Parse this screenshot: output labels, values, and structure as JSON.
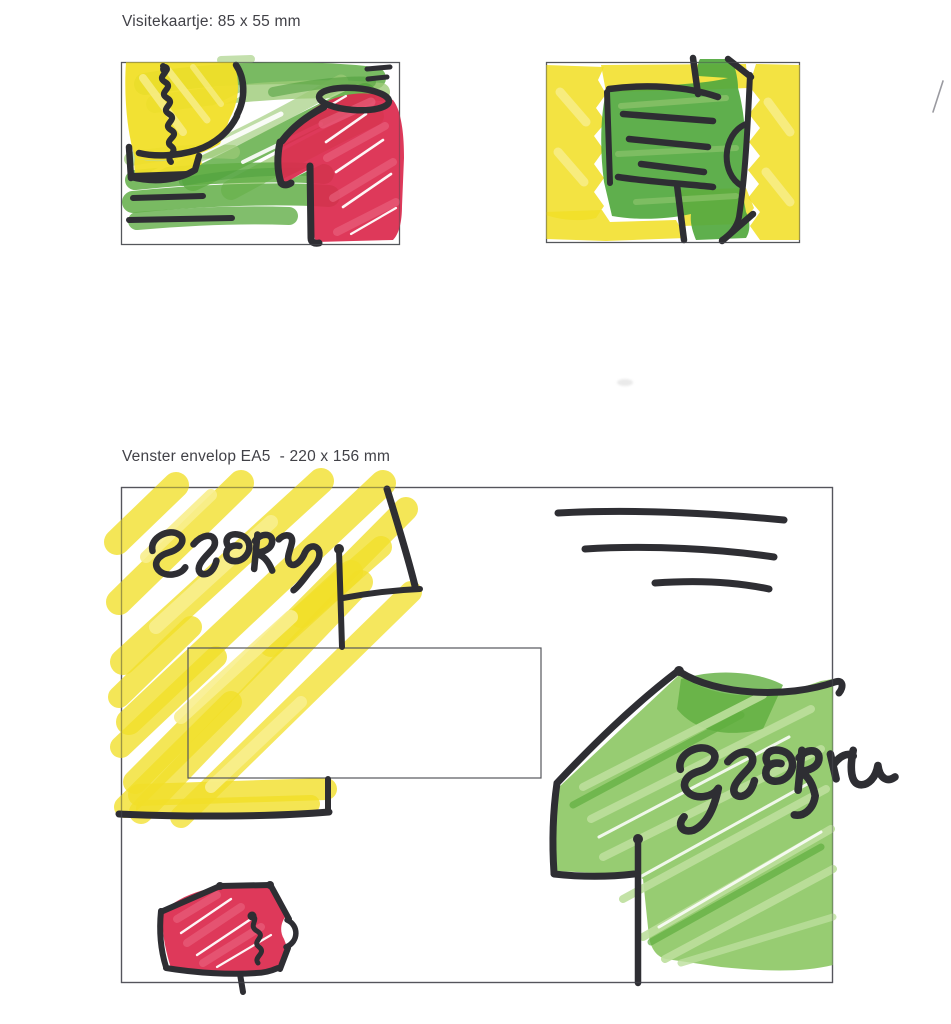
{
  "labels": {
    "business_card": "Visitekaartje: 85 x 55 mm",
    "envelope": "Venster envelop EA5  - 220 x 156 mm"
  },
  "handwriting": {
    "envelope_tag": "STORM",
    "shirt_tag": "STORM"
  },
  "colors": {
    "paper": "#ffffff",
    "label_text": "#414147",
    "ink": "#2e2e33",
    "frame": "#55565c",
    "yellow": "#f1df28",
    "yellow_light": "#f8ee8d",
    "green": "#61ae47",
    "green_light": "#9ccb77",
    "green_dark": "#4c9d3b",
    "green_shirt": "#53a93f",
    "green_env": "#8cc763",
    "green_env_light": "#bcdf9c",
    "green_env_dark": "#5fae3f",
    "red": "#dc2a4e",
    "red_light": "#ea6580"
  }
}
